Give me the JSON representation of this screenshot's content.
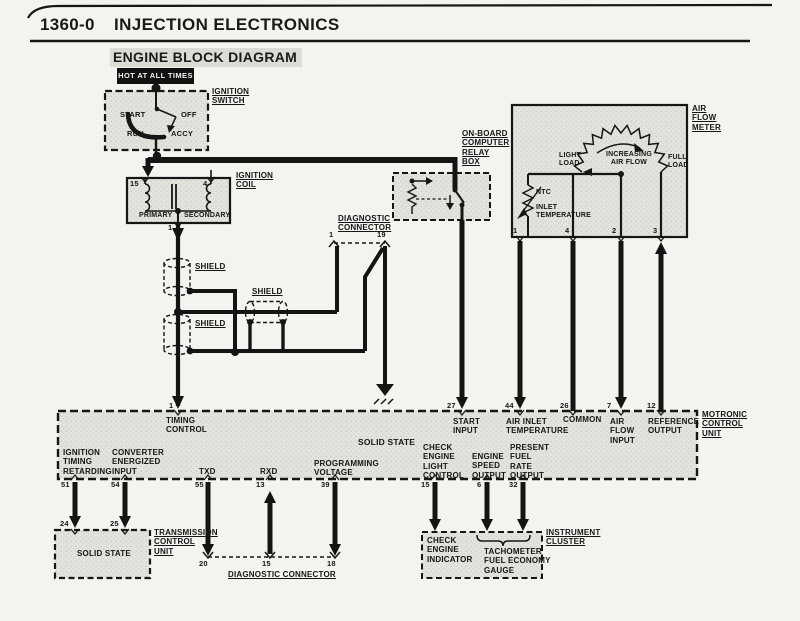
{
  "header": {
    "code": "1360-0",
    "title": "INJECTION ELECTRONICS",
    "subtitle": "ENGINE BLOCK DIAGRAM"
  },
  "power_label": "HOT AT ALL TIMES",
  "ignition_switch": {
    "name": "IGNITION\nSWITCH",
    "positions": {
      "start": "START",
      "off": "OFF",
      "run": "RUN",
      "accy": "ACCY"
    }
  },
  "ignition_coil": {
    "name": "IGNITION\nCOIL",
    "pin_top_left": "15",
    "pin_top_right": "4",
    "pin_bottom": "1",
    "primary": "PRIMARY",
    "secondary": "SECONDARY"
  },
  "shields": {
    "s1": "SHIELD",
    "s2": "SHIELD",
    "s3": "SHIELD"
  },
  "diag_top": {
    "name": "DIAGNOSTIC\nCONNECTOR",
    "pin_left": "1",
    "pin_right": "19"
  },
  "relay_box": {
    "name": "ON-BOARD\nCOMPUTER\nRELAY\nBOX"
  },
  "air_flow_meter": {
    "name": "AIR\nFLOW\nMETER",
    "light_load": "LIGHT\nLOAD",
    "increasing": "INCREASING\nAIR FLOW",
    "full_load": "FULL\nLOAD",
    "ntc": "NTC",
    "inlet_temp": "INLET\nTEMPERATURE",
    "pins": [
      "1",
      "4",
      "2",
      "3"
    ]
  },
  "motronic": {
    "name": "MOTRONIC\nCONTROL\nUNIT",
    "solid_state": "SOLID STATE",
    "top_pins": [
      {
        "n": "1",
        "label": "TIMING\nCONTROL"
      },
      {
        "n": "27",
        "label": "START\nINPUT"
      },
      {
        "n": "44",
        "label": "AIR INLET\nTEMPERATURE"
      },
      {
        "n": "26",
        "label": "COMMON"
      },
      {
        "n": "7",
        "label": "AIR\nFLOW\nINPUT"
      },
      {
        "n": "12",
        "label": "REFERENCE\nOUTPUT"
      }
    ],
    "bottom_pins": [
      {
        "n": "51",
        "label": "IGNITION\nTIMING\nRETARDING"
      },
      {
        "n": "54",
        "label": "CONVERTER\nENERGIZED\nINPUT"
      },
      {
        "n": "55",
        "label": "TXD"
      },
      {
        "n": "13",
        "label": "RXD"
      },
      {
        "n": "39",
        "label": "PROGRAMMING\nVOLTAGE"
      },
      {
        "n": "15",
        "label": "CHECK\nENGINE\nLIGHT\nCONTROL"
      },
      {
        "n": "6",
        "label": "ENGINE\nSPEED\nOUTPUT"
      },
      {
        "n": "32",
        "label": "PRESENT\nFUEL\nRATE\nOUTPUT"
      }
    ]
  },
  "transmission": {
    "name": "TRANSMISSION\nCONTROL\nUNIT",
    "solid_state": "SOLID STATE",
    "pin_left": "24",
    "pin_right": "25"
  },
  "diag_bottom": {
    "name": "DIAGNOSTIC CONNECTOR",
    "pins": [
      "20",
      "15",
      "18"
    ]
  },
  "instrument_cluster": {
    "name": "INSTRUMENT\nCLUSTER",
    "check_engine": "CHECK\nENGINE\nINDICATOR",
    "gauge": "TACHOMETER\nFUEL ECONOMY\nGAUGE"
  },
  "colors": {
    "ink": "#161616",
    "paper": "#f4f3ef",
    "box_fill": "#e3e2dc"
  }
}
